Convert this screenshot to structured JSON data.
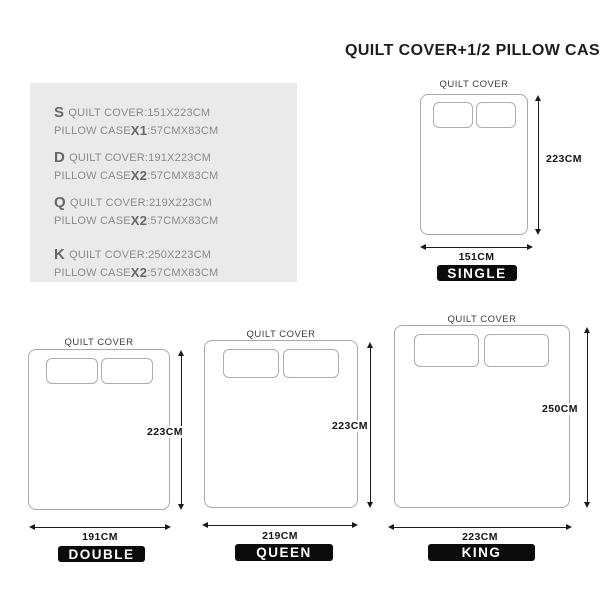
{
  "title": "QUILT COVER+1/2 PILLOW CASE",
  "specs": [
    {
      "letter": "S",
      "quilt": "QUILT COVER:151X223CM",
      "pillow_label": "PILLOW CASE",
      "pillow_qty": "X1",
      "pillow_dims": ":57CMX83CM"
    },
    {
      "letter": "D",
      "quilt": "QUILT COVER:191X223CM",
      "pillow_label": "PILLOW CASE",
      "pillow_qty": "X2",
      "pillow_dims": ":57CMX83CM"
    },
    {
      "letter": "Q",
      "quilt": "QUILT COVER:219X223CM",
      "pillow_label": "PILLOW CASE",
      "pillow_qty": "X2",
      "pillow_dims": ":57CMX83CM"
    },
    {
      "letter": "K",
      "quilt": "QUILT COVER:250X223CM",
      "pillow_label": "PILLOW CASE",
      "pillow_qty": "X2",
      "pillow_dims": ":57CMX83CM"
    }
  ],
  "diagrams": [
    {
      "id": "single",
      "quilt_label": "QUILT COVER",
      "height": "223CM",
      "width": "151CM",
      "size": "SINGLE"
    },
    {
      "id": "double",
      "quilt_label": "QUILT COVER",
      "height": "223CM",
      "width": "191CM",
      "size": "DOUBLE"
    },
    {
      "id": "queen",
      "quilt_label": "QUILT COVER",
      "height": "223CM",
      "width": "219CM",
      "size": "QUEEN"
    },
    {
      "id": "king",
      "quilt_label": "QUILT COVER",
      "height": "250CM",
      "width": "223CM",
      "size": "KING"
    }
  ],
  "colors": {
    "specs_bg": "#eaeaea",
    "badge_bg": "#0b0b0b",
    "badge_text": "#ffffff",
    "bed_border": "#a9a9a9",
    "arrow": "#1a1a1a"
  }
}
